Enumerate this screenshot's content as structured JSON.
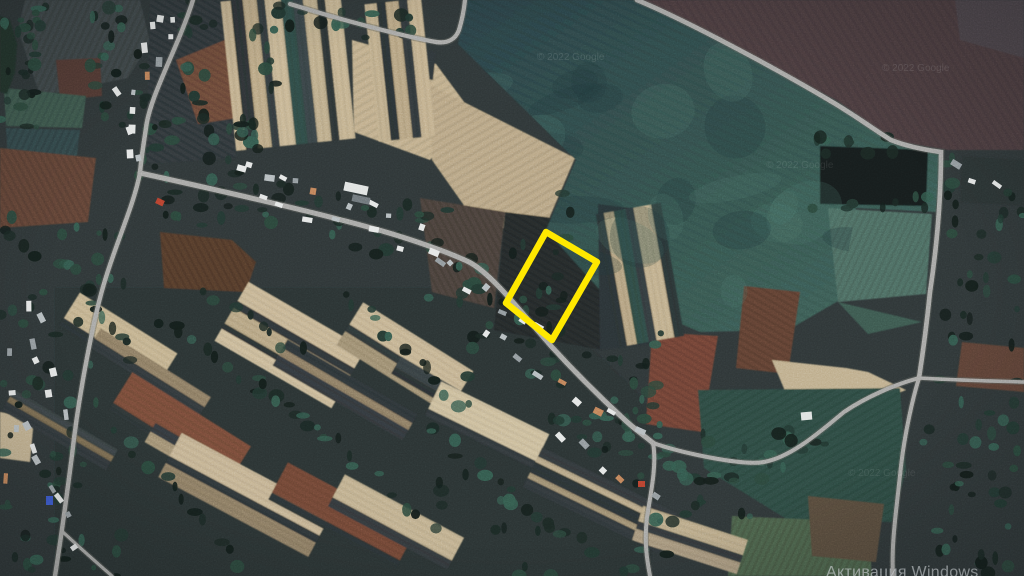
{
  "map": {
    "highlighted_parcel": {
      "points": "546,232 597,262 552,340 506,303",
      "outline_color": "#ffe600"
    }
  },
  "watermarks": {
    "google_copyright": "© 2022 Google",
    "windows_activation": "Активация Windows"
  }
}
